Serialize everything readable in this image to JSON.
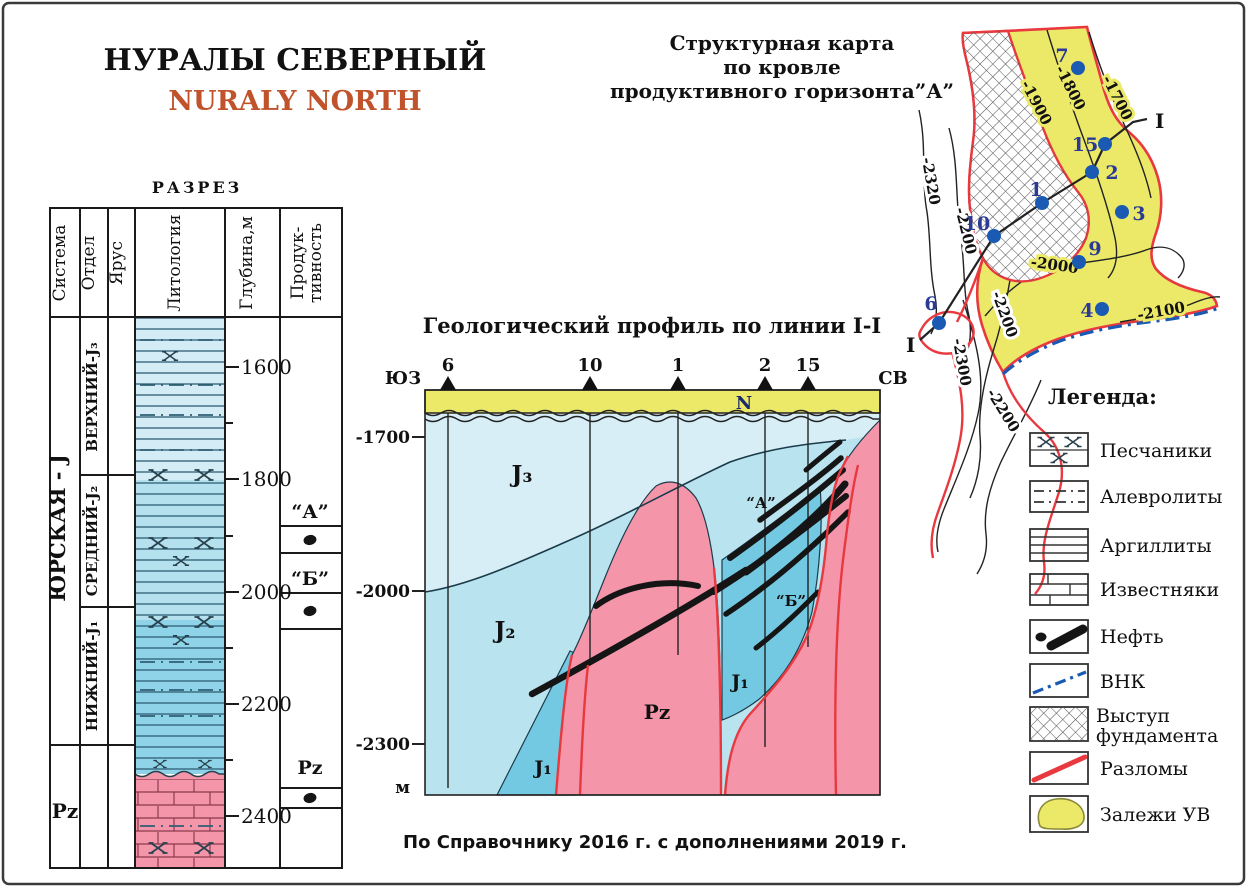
{
  "page": {
    "title_ru": "НУРАЛЫ СЕВЕРНЫЙ",
    "title_en": "NURALY NORTH",
    "source_note": "По Справочнику 2016 г. с дополнениями 2019 г."
  },
  "colors": {
    "title_accent": "#c0532b",
    "field_yellow": "#ece969",
    "basement_pink": "#f595aa",
    "j3_light_blue": "#d8eef6",
    "j2_blue": "#b9e3ef",
    "j1_blue": "#74c9e2",
    "fault_red": "#e8393f",
    "well_blue": "#1b5ab3",
    "oil_black": "#151515"
  },
  "column": {
    "title": "РАЗРЕЗ",
    "headers": {
      "system": "Система",
      "series": "Отдел",
      "stage": "Ярус",
      "lithology": "Литология",
      "depth": "Глубина,м",
      "productivity_line1": "Продук-",
      "productivity_line2": "тивность"
    },
    "system_jurassic": "ЮРСКАЯ - J",
    "system_paleozoic": "Pz",
    "series_labels": [
      "ВЕРХНИЙ-J₃",
      "СРЕДНИЙ-J₂",
      "НИЖНИЙ-J₁"
    ],
    "depth_ticks": [
      "1600",
      "1800",
      "2000",
      "2200",
      "2400"
    ],
    "productivity": {
      "horizon_a": "“А”",
      "horizon_b": "“Б”",
      "pz": "Pz"
    }
  },
  "profile": {
    "title": "Геологический профиль по линии I-I",
    "direction_left": "ЮЗ",
    "direction_right": "СВ",
    "wells": [
      "6",
      "10",
      "1",
      "2",
      "15"
    ],
    "layer_labels": {
      "n": "N",
      "j3": "J₃",
      "j2": "J₂",
      "j1": "J₁",
      "pz": "Pz"
    },
    "horizon_a": "“А”",
    "horizon_b": "“Б”",
    "depth_ticks": [
      "-1700",
      "-2000",
      "-2300"
    ],
    "depth_unit": "м"
  },
  "map": {
    "title_line1": "Структурная карта",
    "title_line2": "по кровле",
    "title_line3": "продуктивного горизонта”А”",
    "line_label": "I",
    "wells": [
      "7",
      "15",
      "2",
      "1",
      "3",
      "10",
      "9",
      "4",
      "6"
    ],
    "contour_labels": {
      "c1700": "-1700",
      "c1800": "-1800",
      "c1900": "-1900",
      "c2320": "-2320",
      "c2200_west": "-2200",
      "c2000": "-2000",
      "c2100": "-2100",
      "c2200_mid": "-2200",
      "c2300": "-2300",
      "c2200_south": "-2200"
    }
  },
  "legend": {
    "title": "Легенда:",
    "items": [
      "Песчаники",
      "Алевролиты",
      "Аргиллиты",
      "Известняки",
      "Нефть",
      "ВНК",
      "Выступ фундамента",
      "Разломы",
      "Залежи УВ"
    ],
    "basement_lines": [
      "Выступ",
      "фундамента"
    ]
  }
}
